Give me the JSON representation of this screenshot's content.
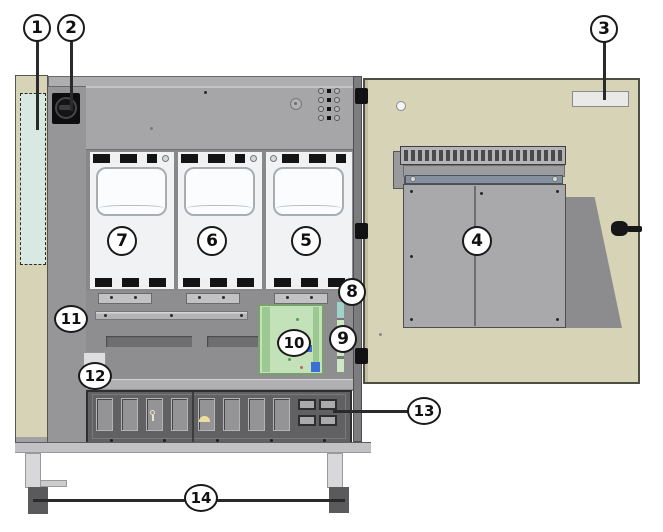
{
  "diagram": {
    "callouts": [
      {
        "number": "1",
        "target": "side-panel-highlight-region"
      },
      {
        "number": "2",
        "target": "main-switch-knob"
      },
      {
        "number": "3",
        "target": "door-label"
      },
      {
        "number": "4",
        "target": "door-mounted-enclosure"
      },
      {
        "number": "5",
        "target": "module-right"
      },
      {
        "number": "6",
        "target": "module-center"
      },
      {
        "number": "7",
        "target": "module-left"
      },
      {
        "number": "8",
        "target": "vertical-strip-upper"
      },
      {
        "number": "9",
        "target": "vertical-strip-lower"
      },
      {
        "number": "10",
        "target": "circuit-board"
      },
      {
        "number": "11",
        "target": "busbar"
      },
      {
        "number": "12",
        "target": "side-cutout"
      },
      {
        "number": "13",
        "target": "terminal-panel-connector"
      },
      {
        "number": "14",
        "target": "leveling-feet"
      }
    ],
    "colors": {
      "door_tan": "#d7d3b6",
      "cabinet_gray": "#9a9a9c",
      "top_panel_gray": "#a6a6a8",
      "mid_gray": "#8e8e90",
      "terminal_panel_dark": "#616163",
      "module_white": "#f1f2f3",
      "pcb_green": "#c4e2ba",
      "highlight_mint": "#d8e9e1",
      "strip_teal": "#9ed2ca",
      "component_blue": "#3a6fd8",
      "foot_dark": "#5a5a5c",
      "callout_border": "#1a1a1a"
    }
  }
}
